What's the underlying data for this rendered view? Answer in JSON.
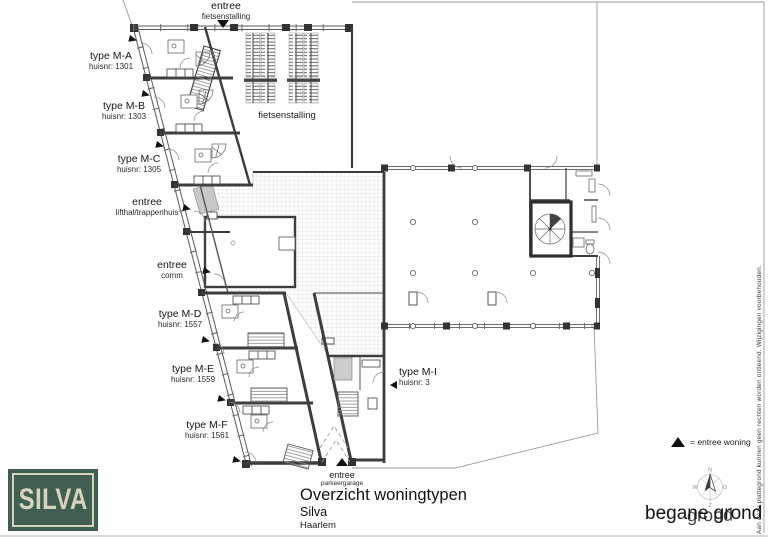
{
  "plan": {
    "units": [
      {
        "type": "type M-A",
        "huisnr": "huisnr: 1301"
      },
      {
        "type": "type M-B",
        "huisnr": "huisnr: 1303"
      },
      {
        "type": "type M-C",
        "huisnr": "huisnr: 1305"
      },
      {
        "type": "type M-D",
        "huisnr": "huisnr: 1557"
      },
      {
        "type": "type M-E",
        "huisnr": "huisnr: 1559"
      },
      {
        "type": "type M-F",
        "huisnr": "huisnr: 1561"
      },
      {
        "type": "type M-I",
        "huisnr": "huisnr: 3"
      }
    ],
    "entrances": {
      "fietsenstalling": {
        "line1": "entree",
        "line2": "fietsenstalling"
      },
      "lifthal": {
        "line1": "entree",
        "line2": "lifthal/trappenhuis"
      },
      "comm": {
        "line1": "entree",
        "line2": "comm"
      },
      "parkeergarage": {
        "line1": "entree",
        "line2": "parkeergarage"
      }
    },
    "room_labels": {
      "fietsenstalling": "fietsenstalling"
    }
  },
  "legend": {
    "symbol": "▲",
    "text": "= entree woning"
  },
  "compass": {
    "n": "N",
    "e": "O",
    "s": "Z",
    "w": "W"
  },
  "title_block": {
    "title": "Overzicht woningtypen",
    "project": "Silva",
    "city": "Haarlem"
  },
  "floor": {
    "label": "begane grond",
    "overprint": "grond"
  },
  "logo": {
    "text": "SILVA"
  },
  "disclaimer": "Aan deze plattegrond kunnen geen rechten worden ontleend. Wijzigingen voorbehouden.",
  "colors": {
    "wall": "#3d3d3d",
    "thin_line": "#8f8f8f",
    "hatch": "#d6d6d6",
    "logo_green": "#415f50",
    "logo_cream": "#d8d2c1",
    "marker": "#111111"
  }
}
